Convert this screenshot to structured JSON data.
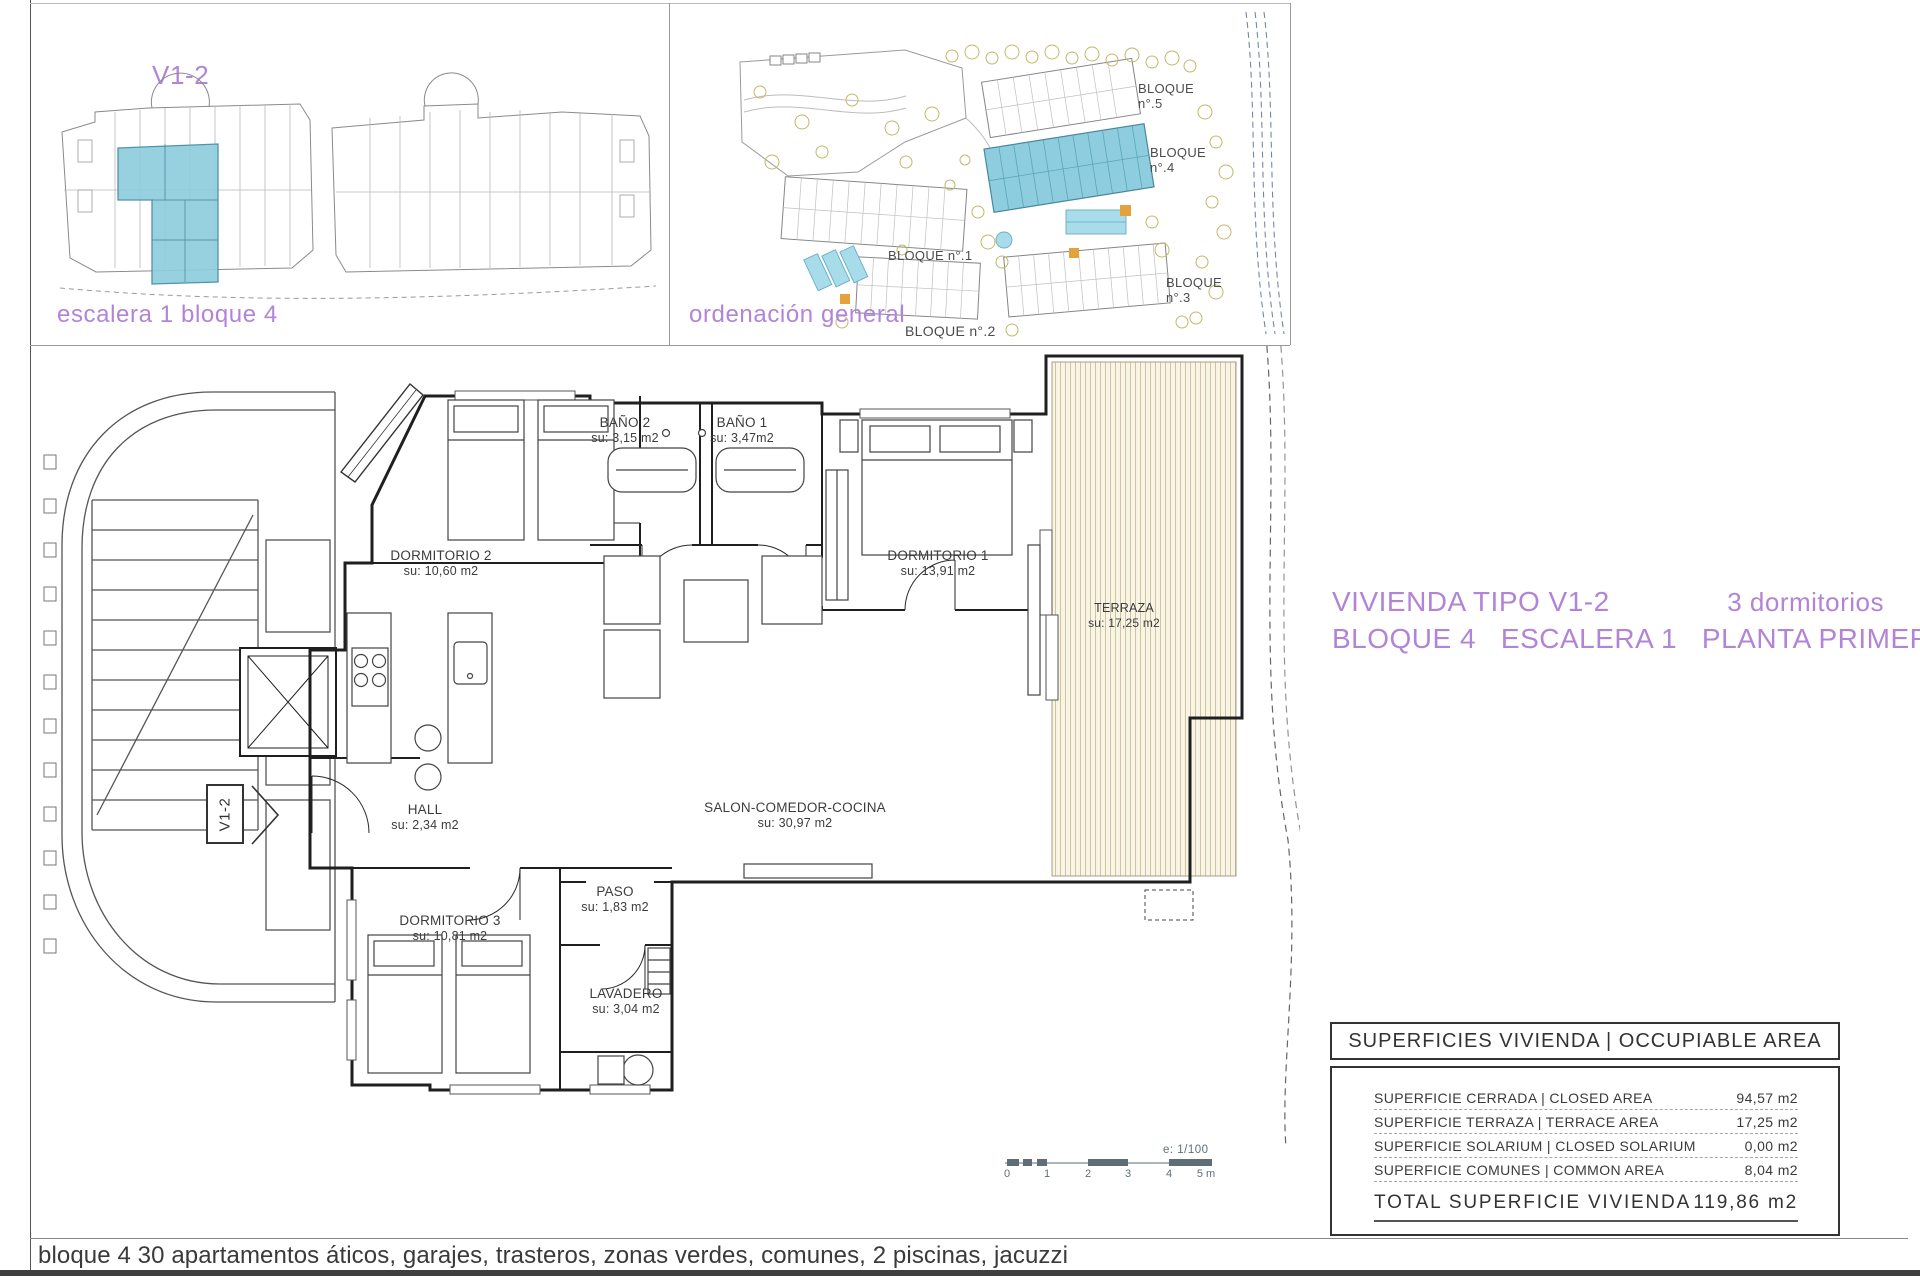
{
  "colors": {
    "accent_purple": "#b284d8",
    "highlight_fill": "#8ecddd",
    "highlight_stroke": "#4e93ab",
    "plan_line": "#222222",
    "terrace_hatch_bg": "#f8f4e6",
    "pool_blue": "#a9dcea",
    "tree_olive": "#c2b968",
    "scalebar_gray": "#5f6e76"
  },
  "overview": {
    "title": "V1-2",
    "caption": "escalera 1 bloque 4"
  },
  "site": {
    "caption": "ordenación general",
    "blocks": [
      "BLOQUE n°.5",
      "BLOQUE n°.4",
      "BLOQUE n°.1",
      "BLOQUE n°.2",
      "BLOQUE n°.3"
    ]
  },
  "heading": {
    "type": "VIVIENDA TIPO V1-2",
    "bedrooms": "3 dormitorios",
    "location": "BLOQUE 4   ESCALERA 1   PLANTA PRIMERA"
  },
  "plan": {
    "tag": "V1-2",
    "rooms": {
      "bano2": {
        "name": "BAÑO 2",
        "area": "su: 3,15 m2"
      },
      "bano1": {
        "name": "BAÑO 1",
        "area": "su: 3,47m2"
      },
      "dorm2": {
        "name": "DORMITORIO 2",
        "area": "su: 10,60 m2"
      },
      "dorm1": {
        "name": "DORMITORIO 1",
        "area": "su: 13,91 m2"
      },
      "terraza": {
        "name": "TERRAZA",
        "area": "su: 17,25 m2"
      },
      "hall": {
        "name": "HALL",
        "area": "su: 2,34 m2"
      },
      "salon": {
        "name": "SALON-COMEDOR-COCINA",
        "area": "su: 30,97 m2"
      },
      "dorm3": {
        "name": "DORMITORIO 3",
        "area": "su: 10,81 m2"
      },
      "paso": {
        "name": "PASO",
        "area": "su: 1,83 m2"
      },
      "lavadero": {
        "name": "LAVADERO",
        "area": "su: 3,04 m2"
      }
    },
    "scale": {
      "label": "e: 1/100",
      "ticks": [
        "0",
        "1",
        "2",
        "3",
        "4",
        "5 m"
      ]
    }
  },
  "table": {
    "header": "SUPERFICIES VIVIENDA | OCCUPIABLE AREA",
    "rows": [
      {
        "label": "SUPERFICIE CERRADA | CLOSED AREA",
        "value": "94,57 m2"
      },
      {
        "label": "SUPERFICIE TERRAZA  | TERRACE AREA",
        "value": "17,25 m2"
      },
      {
        "label": "SUPERFICIE SOLARIUM | CLOSED SOLARIUM",
        "value": "0,00 m2"
      },
      {
        "label": "SUPERFICIE COMUNES | COMMON AREA",
        "value": "8,04 m2"
      }
    ],
    "total": {
      "label": "TOTAL SUPERFICIE VIVIENDA",
      "value": "119,86 m2"
    }
  },
  "footer": "bloque 4 30 apartamentos áticos, garajes, trasteros, zonas verdes, comunes, 2 piscinas, jacuzzi"
}
